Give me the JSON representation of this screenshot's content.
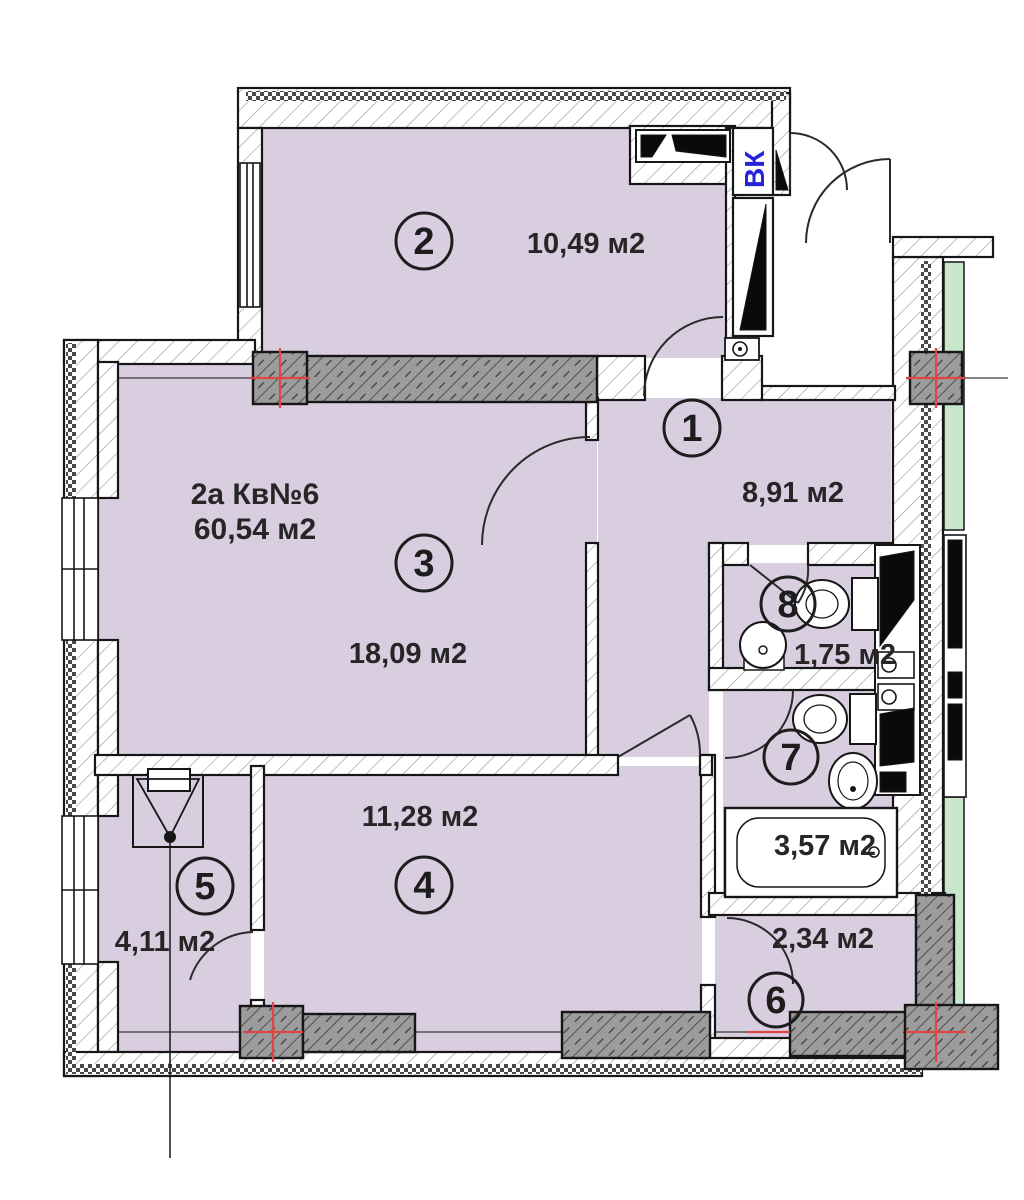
{
  "apartment": {
    "name": "2а Кв№6",
    "total_area": "60,54 м2"
  },
  "shaft_label": "ВК",
  "rooms": [
    {
      "number": "1",
      "area": "8,91 м2"
    },
    {
      "number": "2",
      "area": "10,49 м2"
    },
    {
      "number": "3",
      "area": "18,09 м2"
    },
    {
      "number": "4",
      "area": "11,28 м2"
    },
    {
      "number": "5",
      "area": "4,11 м2"
    },
    {
      "number": "6",
      "area": "2,34 м2"
    },
    {
      "number": "7",
      "area": "3,57 м2"
    },
    {
      "number": "8",
      "area": "1,75 м2"
    }
  ],
  "colors": {
    "room_fill": "#d9cee0",
    "balcony_fill": "#c9e7ca",
    "column_fill": "#9c9c9c",
    "axis_red": "#e04545",
    "vk_blue": "#2424d8"
  }
}
